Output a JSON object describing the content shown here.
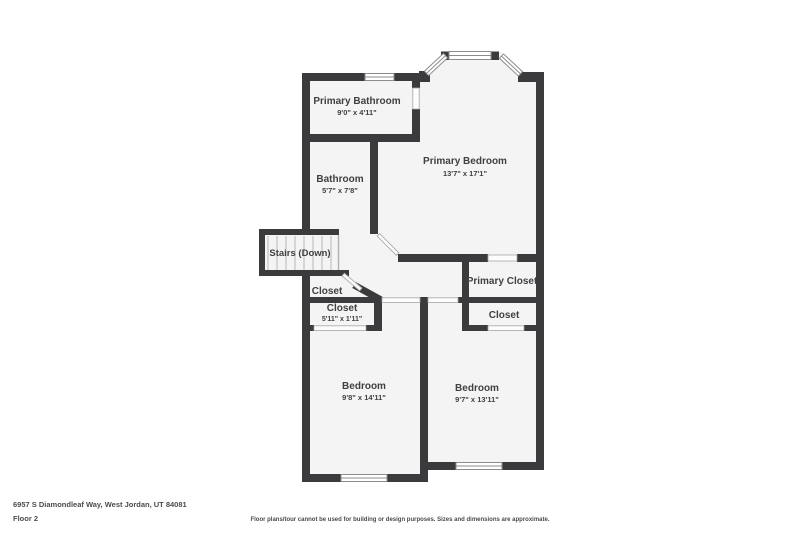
{
  "plan": {
    "colors": {
      "wall": "#3b3b3d",
      "room_fill": "#f4f4f4",
      "window_line": "#8c8c8c",
      "stair_tread": "#c7c7c7",
      "label_text": "#3f4042",
      "footer_text": "#4b4b4d"
    },
    "rooms": {
      "primary_bathroom": {
        "name": "Primary Bathroom",
        "dims": "9'0\" x 4'11\""
      },
      "bathroom": {
        "name": "Bathroom",
        "dims": "5'7\" x 7'8\""
      },
      "primary_bedroom": {
        "name": "Primary Bedroom",
        "dims": "13'7\" x 17'1\""
      },
      "stairs": {
        "name": "Stairs (Down)"
      },
      "hall_closet": {
        "name": "Closet"
      },
      "closet_small": {
        "name": "Closet",
        "dims": "5'11\" x 1'11\""
      },
      "primary_closet": {
        "name": "Primary Closet"
      },
      "closet_right": {
        "name": "Closet"
      },
      "bedroom_left": {
        "name": "Bedroom",
        "dims": "9'8\" x 14'11\""
      },
      "bedroom_right": {
        "name": "Bedroom",
        "dims": "9'7\" x 13'11\""
      }
    }
  },
  "footer": {
    "address": "6957 S Diamondleaf Way, West Jordan, UT 84081",
    "floor_label": "Floor 2",
    "disclaimer": "Floor plans/tour cannot be used for building or design purposes. Sizes and dimensions are approximate."
  }
}
